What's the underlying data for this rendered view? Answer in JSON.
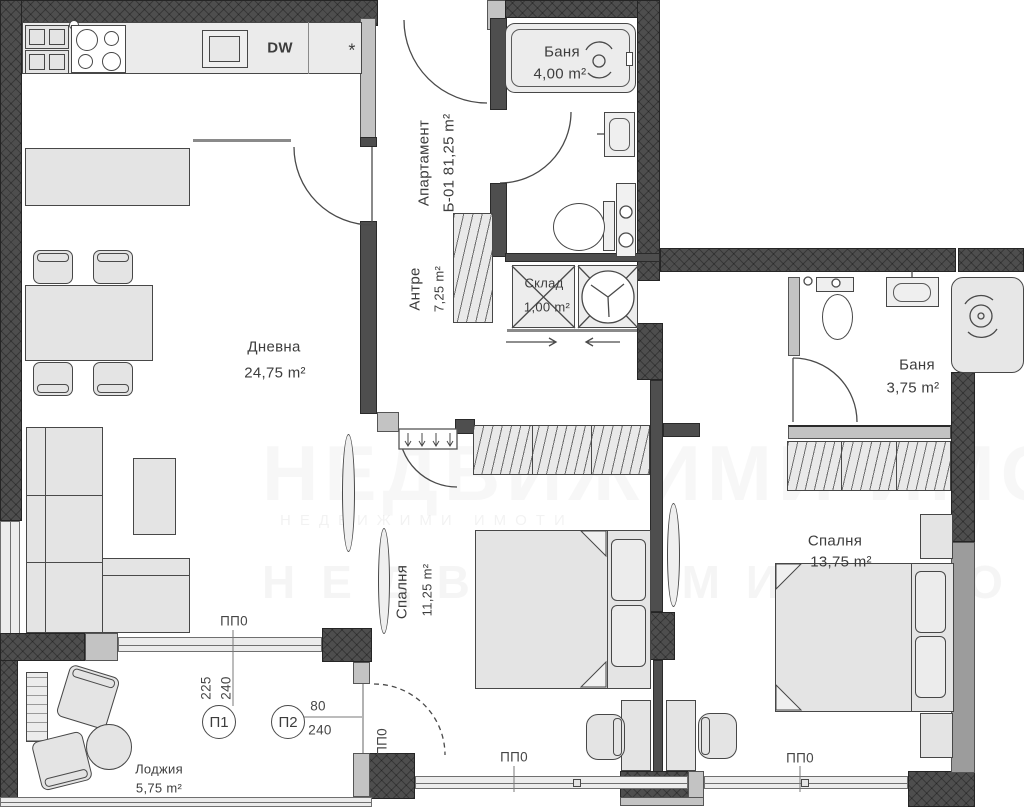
{
  "plan": {
    "watermark": {
      "text": "НЕДВИЖИМИ ИМОТИ"
    },
    "apartment": {
      "label": "Апартамент",
      "code": "Б-01 81,25 m²"
    },
    "rooms": {
      "living": {
        "name": "Дневна",
        "area": "24,75 m²"
      },
      "hall": {
        "name": "Антре",
        "area": "7,25 m²"
      },
      "bath1": {
        "name": "Баня",
        "area": "4,00 m²"
      },
      "storage": {
        "name": "Склад",
        "area": "1,00 m²"
      },
      "bath2": {
        "name": "Баня",
        "area": "3,75 m²"
      },
      "bedroom1": {
        "name": "Спалня",
        "area": "11,25 m²"
      },
      "bedroom2": {
        "name": "Спалня",
        "area": "13,75 m²"
      },
      "loggia": {
        "name": "Лоджия",
        "area": "5,75 m²"
      }
    },
    "kitchen": {
      "dishwasher": "DW",
      "star": "*"
    },
    "dims": {
      "pp0": "ПП0",
      "p1": {
        "id": "П1",
        "w": "225",
        "h": "240"
      },
      "p2": {
        "id": "П2",
        "w": "80",
        "h": "240"
      }
    },
    "colors": {
      "wall_dark": "#4e4e4e",
      "wall_gray": "#c3c3c3",
      "fill": "#e4e4e4",
      "line": "#3c3c3c",
      "window": "#ececec"
    }
  }
}
